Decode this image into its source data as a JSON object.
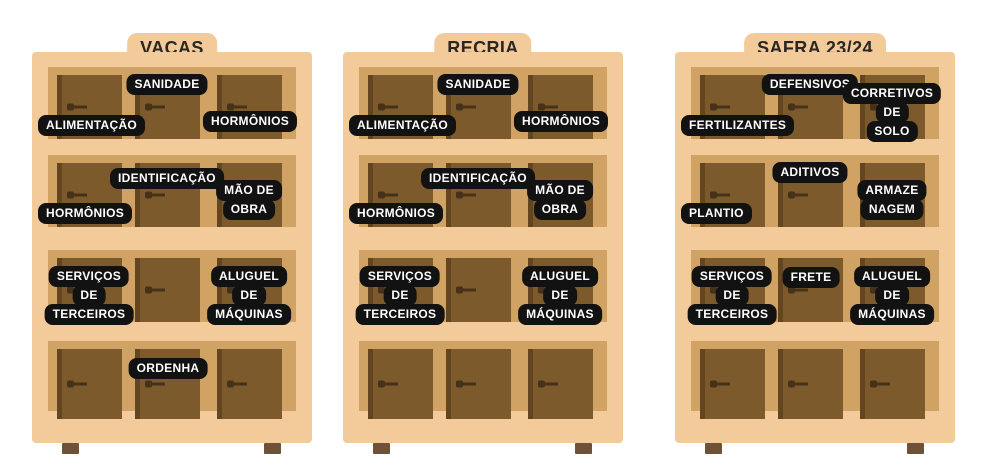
{
  "colors": {
    "cabinet_body": "#F3CB9B",
    "shelf_inset": "#D0A364",
    "door": "#7C5A2B",
    "door_edge": "#63461F",
    "door_handle": "#46311A",
    "label_background": "#121212",
    "label_text": "#FFFFFF",
    "title_text": "#2B2622",
    "foot": "#6F5138",
    "page_background": "#FFFFFF"
  },
  "cabinets": [
    {
      "title": "VACAS",
      "rows": [
        {
          "labels": [
            {
              "lines": [
                "ALIMENTAÇÃO"
              ],
              "pos": "left-bottom"
            },
            {
              "lines": [
                "SANIDADE"
              ],
              "pos": "center-top"
            },
            {
              "lines": [
                "HORMÔNIOS"
              ],
              "pos": "right-mid"
            }
          ]
        },
        {
          "labels": [
            {
              "lines": [
                "HORMÔNIOS"
              ],
              "pos": "left-bottom"
            },
            {
              "lines": [
                "IDENTIFICAÇÃO"
              ],
              "pos": "center-top-mid"
            },
            {
              "lines": [
                "MÃO DE",
                "OBRA"
              ],
              "pos": "right-mid-stack"
            }
          ]
        },
        {
          "labels": [
            {
              "lines": [
                "SERVIÇOS",
                "DE",
                "TERCEIROS"
              ],
              "pos": "left-stack"
            },
            {
              "lines": [
                "ALUGUEL",
                "DE",
                "MÁQUINAS"
              ],
              "pos": "right-stack"
            }
          ]
        },
        {
          "labels": [
            {
              "lines": [
                "ORDENHA"
              ],
              "pos": "center-top-low"
            }
          ]
        }
      ]
    },
    {
      "title": "RECRIA",
      "rows": [
        {
          "labels": [
            {
              "lines": [
                "ALIMENTAÇÃO"
              ],
              "pos": "left-bottom"
            },
            {
              "lines": [
                "SANIDADE"
              ],
              "pos": "center-top"
            },
            {
              "lines": [
                "HORMÔNIOS"
              ],
              "pos": "right-mid"
            }
          ]
        },
        {
          "labels": [
            {
              "lines": [
                "HORMÔNIOS"
              ],
              "pos": "left-bottom"
            },
            {
              "lines": [
                "IDENTIFICAÇÃO"
              ],
              "pos": "center-top-mid"
            },
            {
              "lines": [
                "MÃO DE",
                "OBRA"
              ],
              "pos": "right-mid-stack"
            }
          ]
        },
        {
          "labels": [
            {
              "lines": [
                "SERVIÇOS",
                "DE",
                "TERCEIROS"
              ],
              "pos": "left-stack"
            },
            {
              "lines": [
                "ALUGUEL",
                "DE",
                "MÁQUINAS"
              ],
              "pos": "right-stack"
            }
          ]
        },
        {
          "labels": []
        }
      ]
    },
    {
      "title": "SAFRA 23/24",
      "rows": [
        {
          "labels": [
            {
              "lines": [
                "FERTILIZANTES"
              ],
              "pos": "left-bottom"
            },
            {
              "lines": [
                "DEFENSIVOS"
              ],
              "pos": "center-top"
            },
            {
              "lines": [
                "CORRETIVOS",
                "DE",
                "SOLO"
              ],
              "pos": "right-stack"
            }
          ]
        },
        {
          "labels": [
            {
              "lines": [
                "PLANTIO"
              ],
              "pos": "left-bottom"
            },
            {
              "lines": [
                "ADITIVOS"
              ],
              "pos": "center-top"
            },
            {
              "lines": [
                "ARMAZE",
                "NAGEM"
              ],
              "pos": "right-mid-stack"
            }
          ]
        },
        {
          "labels": [
            {
              "lines": [
                "SERVIÇOS",
                "DE",
                "TERCEIROS"
              ],
              "pos": "left-stack"
            },
            {
              "lines": [
                "FRETE"
              ],
              "pos": "center-top-low"
            },
            {
              "lines": [
                "ALUGUEL",
                "DE",
                "MÁQUINAS"
              ],
              "pos": "right-stack"
            }
          ]
        },
        {
          "labels": []
        }
      ]
    }
  ]
}
